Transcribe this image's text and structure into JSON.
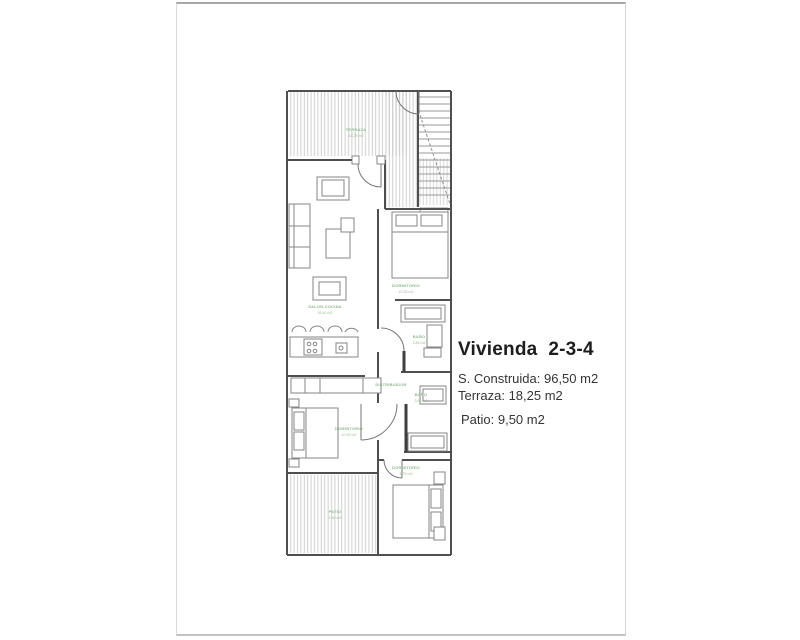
{
  "info": {
    "title": "Vivienda  2-3-4",
    "lines": [
      "S. Construida: 96,50 m2",
      "Terraza: 18,25 m2",
      "Patio: 9,50 m2"
    ]
  },
  "plan": {
    "rooms": {
      "terraza": {
        "name": "TERRAZA",
        "area": "18,25 m2"
      },
      "salon": {
        "name": "SALON-COCINA",
        "area": "26,40 m2"
      },
      "dormitorio1": {
        "name": "DORMITORIO",
        "area": "10,35 m2"
      },
      "bano1": {
        "name": "BAÑO",
        "area": "3,85 m2"
      },
      "distribuidor": {
        "name": "DISTRIBUIDOR",
        "area": ""
      },
      "bano2": {
        "name": "BAÑO",
        "area": "3,60 m2"
      },
      "dormitorio2": {
        "name": "DORMITORIO",
        "area": "10,90 m2"
      },
      "dormitorio3": {
        "name": "DORMITORIO",
        "area": "8,75 m2"
      },
      "patio": {
        "name": "PATIO",
        "area": "9,50 m2"
      }
    },
    "colors": {
      "wall": "#4f4f4f",
      "furniture": "#858585",
      "hatch": "#c9c9c9",
      "label_green": "#8cb98c",
      "title_text": "#1d1d1d",
      "body_text": "#343434"
    }
  }
}
